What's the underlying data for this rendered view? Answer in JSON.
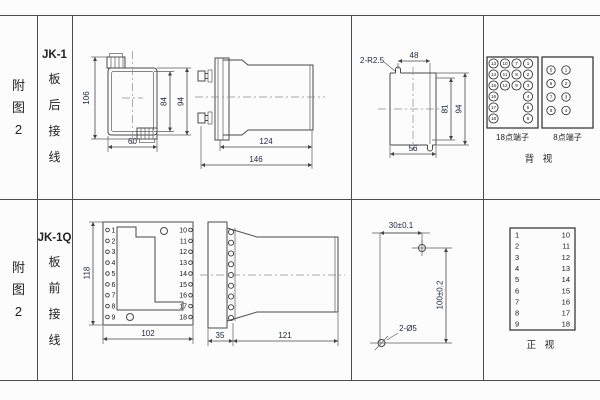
{
  "left_header": {
    "row1": [
      "附",
      "图",
      "2"
    ],
    "row2": [
      "附",
      "图",
      "2"
    ]
  },
  "model_header": {
    "row1": {
      "model": "JK-1",
      "chars": [
        "板",
        "后",
        "接",
        "线"
      ]
    },
    "row2": {
      "model": "JK-1Q",
      "chars": [
        "板",
        "前",
        "接",
        "线"
      ]
    }
  },
  "row1": {
    "front_view": {
      "dim_height": "106",
      "dim_inner": "84",
      "dim_outer": "94",
      "dim_width": "60"
    },
    "side_view": {
      "dim_body": "124",
      "dim_total": "146"
    },
    "cutout_view": {
      "radius_label": "2-R2.5",
      "dim_top": "48",
      "dim_inner_height": "81",
      "dim_outer_height": "94",
      "dim_bottom": "56"
    },
    "terminal_18": {
      "label": "18点端子",
      "columns": [
        [
          13,
          14,
          15,
          16,
          17,
          18
        ],
        [
          10,
          11,
          12
        ],
        [
          7,
          8,
          9
        ],
        [
          1,
          2,
          3,
          4,
          5,
          6
        ]
      ]
    },
    "terminal_8": {
      "label": "8点端子",
      "columns": [
        [
          5,
          6,
          7,
          8
        ],
        [
          1,
          2,
          3,
          4
        ]
      ]
    },
    "view_label": "背 视"
  },
  "row2": {
    "front_view": {
      "dim_height": "118",
      "dim_width": "102",
      "left_terminals": [
        1,
        2,
        3,
        4,
        5,
        6,
        7,
        8,
        9
      ],
      "right_terminals": [
        10,
        11,
        12,
        13,
        14,
        15,
        16,
        17,
        18
      ]
    },
    "side_view": {
      "dim_front": "35",
      "dim_body": "121"
    },
    "drill_view": {
      "dim_horizontal": "30±0.1",
      "dim_vertical": "100±0.2",
      "hole_label": "2-Ø5"
    },
    "terminal_table": {
      "left": [
        1,
        2,
        3,
        4,
        5,
        6,
        7,
        8,
        9
      ],
      "right": [
        10,
        11,
        12,
        13,
        14,
        15,
        16,
        17,
        18
      ]
    },
    "view_label": "正 视"
  }
}
